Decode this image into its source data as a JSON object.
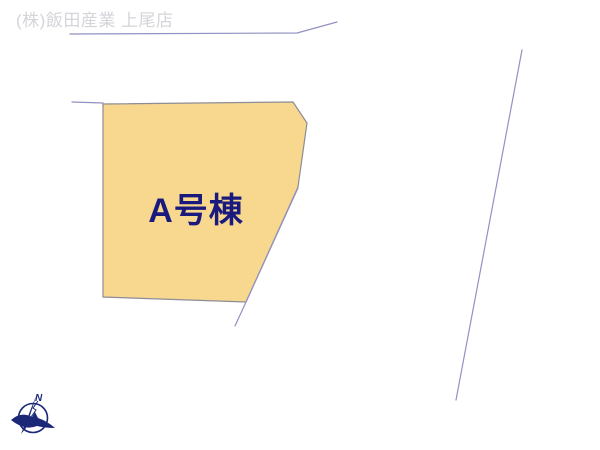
{
  "theme": {
    "company_color": "#d4d4da",
    "line_color": "#9191c2",
    "plot_fill": "#f8d78f",
    "plot_outline": "#8d8d96",
    "plot_label_color": "#1a1a7e",
    "compass_color": "#1b2878"
  },
  "header": {
    "company_label": "(株)飯田産業 上尾店"
  },
  "plot": {
    "label": "A号棟",
    "points": "103,104 293,102 307,123 298,187 246,302 103,297"
  },
  "lines": {
    "top_polyline": "70,34 297,33 337,22",
    "left_segment": "72,102 103,103",
    "lower_extension": "298,188 246,302 235,326",
    "right_line": "522,50 456,400"
  },
  "compass": {
    "label": "N"
  }
}
